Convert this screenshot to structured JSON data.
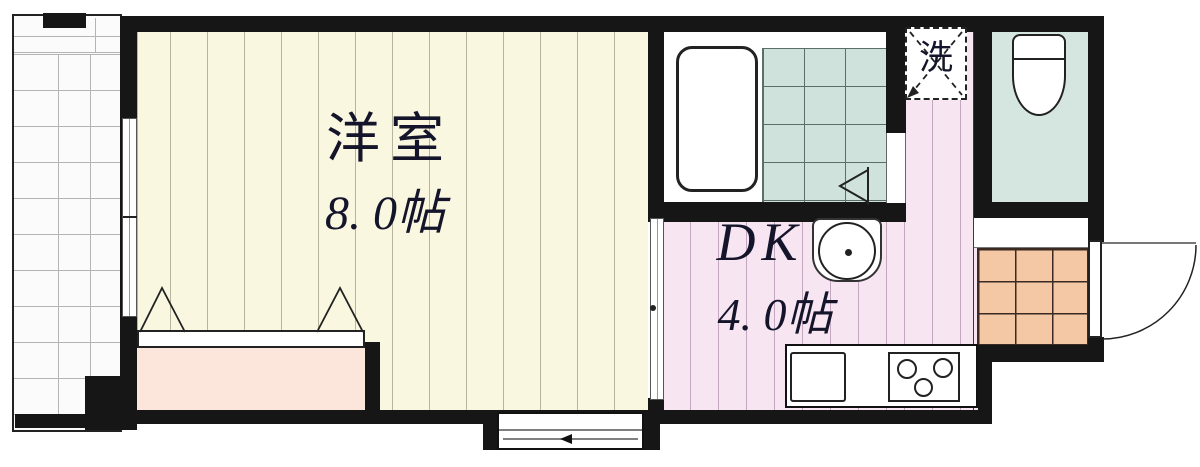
{
  "rooms": {
    "western": {
      "name": "洋室",
      "size": "8. 0帖"
    },
    "dk": {
      "name": "DK",
      "size": "4. 0帖"
    },
    "laundry": {
      "symbol": "洗"
    }
  },
  "fixtures": {
    "bathtub": "bathtub",
    "toilet": "toilet",
    "washbasin": "round-washbasin",
    "kitchen_sink": "kitchen-sink",
    "stove": "three-burner-stove",
    "washer_space": "washing-machine-space",
    "entrance_door": "outward-swing-door",
    "closet": "closet",
    "balcony": "balcony"
  },
  "colors": {
    "wall": "#161616",
    "western_floor": "#faf7e0",
    "dk_floor": "#f8e5f2",
    "closet_fill": "#fce6dc",
    "bath_floor": "#ffffff",
    "bath_tile": "#cfe3dc",
    "toilet_floor": "#d5e5e0",
    "genkan_tile": "#f4c7a5",
    "balcony_floor": "#fbfbfb"
  }
}
